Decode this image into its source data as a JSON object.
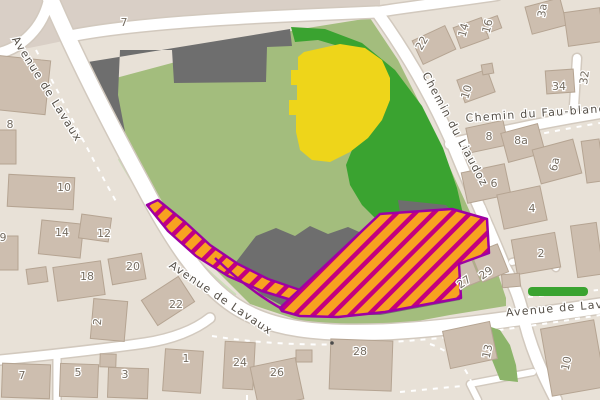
{
  "map": {
    "street_labels": [
      {
        "text": "Avenue de Lavaux",
        "x": 44,
        "y": 91,
        "rotate": 58
      },
      {
        "text": "Avenue de Lavaux",
        "x": 219,
        "y": 301,
        "rotate": 34
      },
      {
        "text": "Avenue de Lavaux",
        "x": 567,
        "y": 311,
        "rotate": -5
      },
      {
        "text": "Chemin du Liaudoz",
        "x": 452,
        "y": 131,
        "rotate": 62
      },
      {
        "text": "Chemin du Fau-blanc",
        "x": 536,
        "y": 117,
        "rotate": -4
      }
    ],
    "house_numbers": [
      {
        "text": "8",
        "x": 10,
        "y": 128,
        "rotate": 0
      },
      {
        "text": "7",
        "x": 124,
        "y": 26,
        "rotate": 0
      },
      {
        "text": "10",
        "x": 64,
        "y": 191,
        "rotate": 0
      },
      {
        "text": "14",
        "x": 62,
        "y": 236,
        "rotate": 0
      },
      {
        "text": "12",
        "x": 104,
        "y": 237,
        "rotate": 0
      },
      {
        "text": "9",
        "x": 3,
        "y": 241,
        "rotate": 0
      },
      {
        "text": "18",
        "x": 87,
        "y": 280,
        "rotate": 0
      },
      {
        "text": "20",
        "x": 133,
        "y": 270,
        "rotate": 0
      },
      {
        "text": "22",
        "x": 176,
        "y": 308,
        "rotate": 0
      },
      {
        "text": "2",
        "x": 101,
        "y": 322,
        "rotate": -85
      },
      {
        "text": "7",
        "x": 22,
        "y": 379,
        "rotate": 0
      },
      {
        "text": "5",
        "x": 78,
        "y": 376,
        "rotate": 0
      },
      {
        "text": "3",
        "x": 125,
        "y": 378,
        "rotate": 0
      },
      {
        "text": "1",
        "x": 186,
        "y": 362,
        "rotate": 0
      },
      {
        "text": "24",
        "x": 240,
        "y": 366,
        "rotate": 0
      },
      {
        "text": "26",
        "x": 277,
        "y": 376,
        "rotate": 0
      },
      {
        "text": "28",
        "x": 360,
        "y": 355,
        "rotate": 0
      },
      {
        "text": "22",
        "x": 425,
        "y": 45,
        "rotate": -60
      },
      {
        "text": "14",
        "x": 467,
        "y": 31,
        "rotate": -75
      },
      {
        "text": "16",
        "x": 491,
        "y": 27,
        "rotate": -75
      },
      {
        "text": "3a",
        "x": 546,
        "y": 11,
        "rotate": -82
      },
      {
        "text": "10",
        "x": 470,
        "y": 93,
        "rotate": -72
      },
      {
        "text": "34",
        "x": 559,
        "y": 90,
        "rotate": 0
      },
      {
        "text": "32",
        "x": 588,
        "y": 78,
        "rotate": -82
      },
      {
        "text": "8",
        "x": 489,
        "y": 140,
        "rotate": 0
      },
      {
        "text": "8a",
        "x": 521,
        "y": 144,
        "rotate": 0
      },
      {
        "text": "6a",
        "x": 558,
        "y": 165,
        "rotate": -78
      },
      {
        "text": "6",
        "x": 494,
        "y": 187,
        "rotate": 0
      },
      {
        "text": "4",
        "x": 532,
        "y": 212,
        "rotate": 0
      },
      {
        "text": "2",
        "x": 541,
        "y": 257,
        "rotate": 0
      },
      {
        "text": "27",
        "x": 466,
        "y": 285,
        "rotate": -35
      },
      {
        "text": "29",
        "x": 488,
        "y": 276,
        "rotate": -35
      },
      {
        "text": "13",
        "x": 491,
        "y": 352,
        "rotate": -78
      },
      {
        "text": "10",
        "x": 570,
        "y": 364,
        "rotate": -78
      }
    ],
    "colors": {
      "background": "#E8E1D7",
      "zone_dark": "#D9CFC6",
      "road": "#FFFFFF",
      "road_casing": "#D2C9BE",
      "grass": "#A3BD7D",
      "grass_pale": "#CCDDB8",
      "forest": "#3AA330",
      "farmland": "#EED51A",
      "gray_area": "#6E6E6E",
      "building": "#CDBEAF",
      "building_outline": "#B5A492",
      "overlay_fill": "#F8A220",
      "overlay_stripe": "#C4007E",
      "overlay_border": "#9E00A3",
      "leaf": "#8CB46A",
      "footpath": "#FFFFFF",
      "street_label_color": "#554F47",
      "house_number_color": "#756C60"
    }
  }
}
